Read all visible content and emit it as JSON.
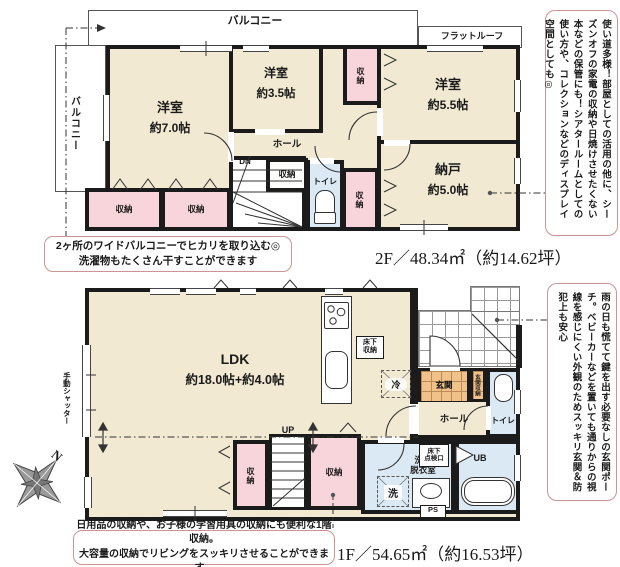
{
  "f2": {
    "balcony_top": "バルコニー",
    "flat_roof": "フラットルーフ",
    "balcony_left": "バルコニー",
    "rooms": {
      "y70": {
        "name": "洋室",
        "size": "約7.0帖"
      },
      "y35": {
        "name": "洋室",
        "size": "約3.5帖"
      },
      "y55": {
        "name": "洋室",
        "size": "約5.5帖"
      },
      "nando": {
        "name": "納戸",
        "size": "約5.0帖"
      }
    },
    "hall": "ホール",
    "dn": "DN",
    "toilet": "トイレ",
    "storage": "収納",
    "note_line1": "2ヶ所のワイドバルコニーでヒカリを取り込む◎",
    "note_line2": "洗濯物もたくさん干すことができます",
    "area": "2F／48.34㎡（約14.62坪）",
    "side_note": "使い道多様！部屋としての活用の他に、シーズンオフの家電の収納や日焼けさせたくない本などの保管にも！シアタールームとしての使い方や、コレクションなどのディスプレイ空間としても◎"
  },
  "f1": {
    "ldk": {
      "name": "LDK",
      "size": "約18.0帖+約4.0帖"
    },
    "shutter": "手動シャッター",
    "floor_storage_l1": "床下",
    "floor_storage_l2": "収納",
    "fridge": "冷",
    "genkan": "玄関",
    "genkan_storage": "玄関収納",
    "hall": "ホール",
    "toilet": "トイレ",
    "up": "UP",
    "storage": "収納",
    "senmen_l1": "洗面",
    "senmen_l2": "脱衣室",
    "wash": "洗",
    "inspect_l1": "床下",
    "inspect_l2": "点検口",
    "ub": "UB",
    "ps": "PS",
    "note_line1": "日用品の収納や、お子様の学習用具の収納にも便利な1階収納。",
    "note_line2": "大容量の収納でリビングをスッキリさせることができます。",
    "area": "1F／54.65㎡（約16.53坪）",
    "side_note": "雨の日も慌てて鍵を出す必要なしの玄関ポーチ。ベビーカーなどを置いても通りからの視線を感じにくい外観のためスッキリ玄関＆防犯上も安心"
  },
  "compass": {
    "north": "N"
  },
  "colors": {
    "room": "#f1e9d2",
    "closet": "#f8d5da",
    "wet": "#dbe9f4",
    "entry": "#f0c189",
    "wall": "#1b1b1b",
    "note_border": "#cc9494"
  }
}
